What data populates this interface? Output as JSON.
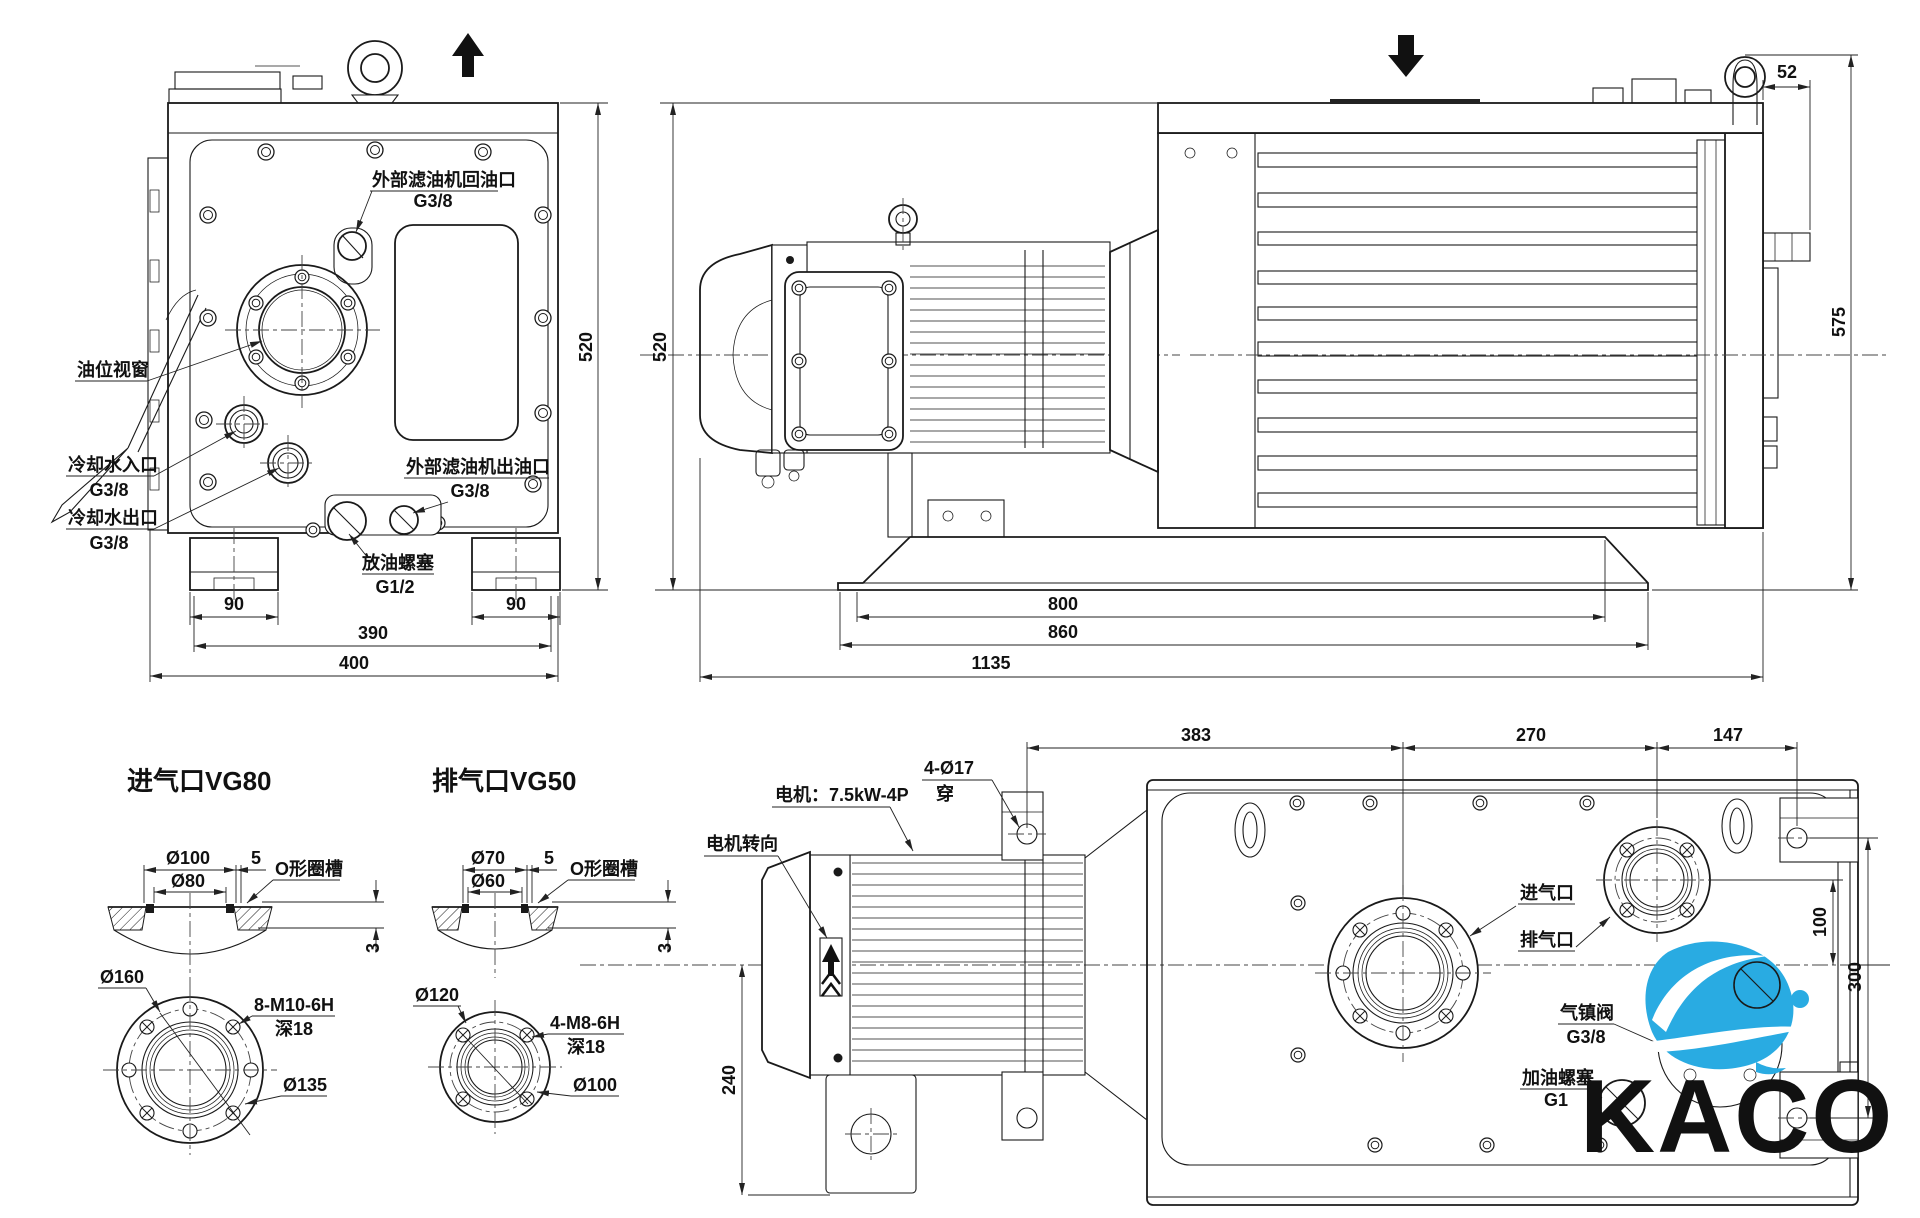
{
  "front_view": {
    "labels": {
      "return_port": "外部滤油机回油口",
      "return_port_size": "G3/8",
      "oil_window": "油位视窗",
      "cool_in": "冷却水入口",
      "cool_in_size": "G3/8",
      "cool_out": "冷却水出口",
      "cool_out_size": "G3/8",
      "filter_out": "外部滤油机出油口",
      "filter_out_size": "G3/8",
      "drain": "放油螺塞",
      "drain_size": "G1/2"
    },
    "dims": {
      "height": "520",
      "foot_l": "90",
      "foot_r": "90",
      "width_inner": "390",
      "width_total": "400"
    }
  },
  "side_view": {
    "dims": {
      "height": "520",
      "offset_top": "52",
      "height_total": "575",
      "base_top": "800",
      "base_bottom": "860",
      "length_total": "1135"
    }
  },
  "inlet_detail": {
    "title": "进气口VG80",
    "labels": {
      "oring": "O形圈槽"
    },
    "dims": {
      "bore_outer": "Ø100",
      "land": "5",
      "bore_inner": "Ø80",
      "groove": "3",
      "flange": "Ø160",
      "thread": "8-M10-6H",
      "depth": "深18",
      "bolt_circle": "Ø135"
    }
  },
  "outlet_detail": {
    "title": "排气口VG50",
    "labels": {
      "oring": "O形圈槽"
    },
    "dims": {
      "bore_outer": "Ø70",
      "land": "5",
      "bore_inner": "Ø60",
      "groove": "3",
      "flange": "Ø120",
      "thread": "4-M8-6H",
      "depth": "深18",
      "bolt_circle": "Ø100"
    }
  },
  "top_view": {
    "labels": {
      "motor": "电机：7.5kW-4P",
      "motor_dir": "电机转向",
      "holes": "4-Ø17",
      "holes_thru": "穿",
      "inlet": "进气口",
      "outlet": "排气口",
      "ballast": "气镇阀",
      "ballast_size": "G3/8",
      "fill": "加油螺塞",
      "fill_size": "G1"
    },
    "dims": {
      "d383": "383",
      "d270": "270",
      "d147": "147",
      "d100": "100",
      "d300": "300",
      "d240": "240"
    }
  },
  "logo": {
    "text": "KACO",
    "blue": "#29abe2",
    "gray": "#58595b"
  }
}
